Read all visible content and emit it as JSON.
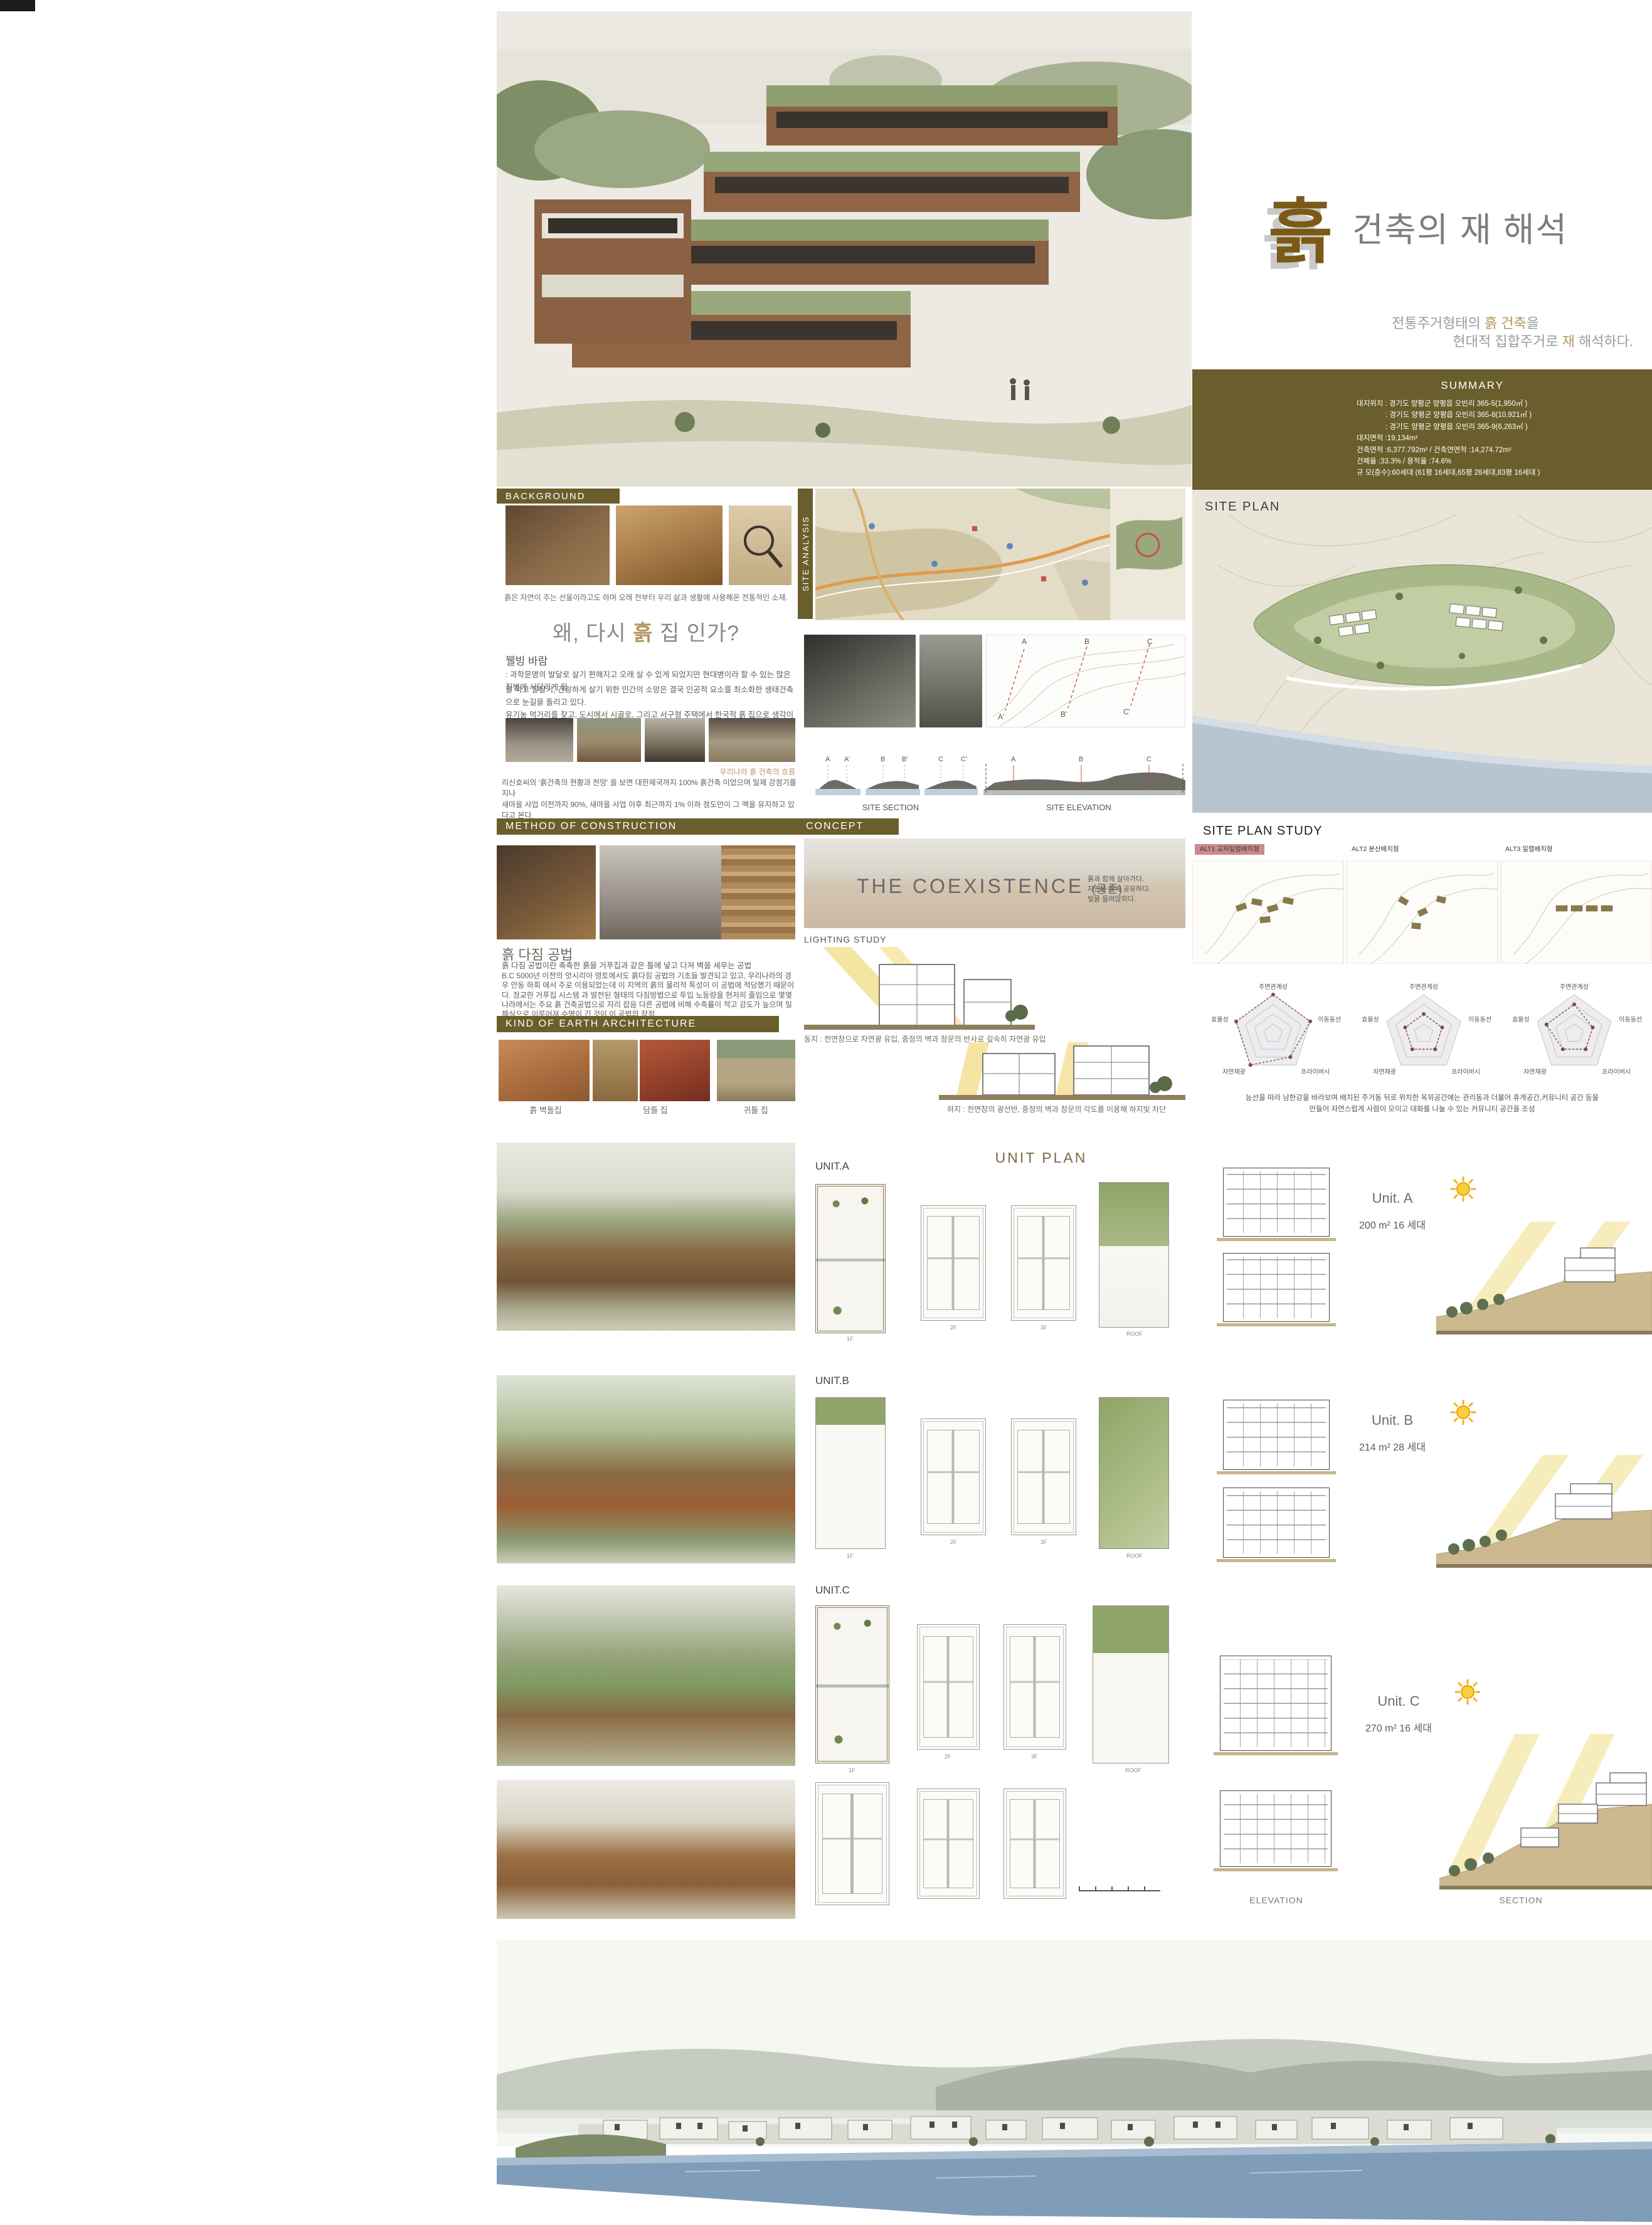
{
  "accent_colors": {
    "olive": "#6a5e2c",
    "tan": "#b3985f",
    "brown_logo": "#7b5a17",
    "alt_highlight": "#c98b8b",
    "radar_line": "#8a564c",
    "light_beam": "#f5df92",
    "water": "#7f9cb8"
  },
  "header": {
    "logo_char": "흙",
    "title": "건축의 재 해석",
    "subtitle": {
      "l1_pre": "전통주거형태의 ",
      "l1_accent": "흙 건축",
      "l1_post": "을",
      "l2_pre": "현대적 집합주거로 ",
      "l2_accent": "재",
      "l2_post": " 해석하다."
    }
  },
  "summary": {
    "heading": "SUMMARY",
    "lines": [
      "대지위치 : 경기도 양평군 양평읍 오빈리 365-5(1,950㎡ )",
      ": 경기도 양평군 양평읍 오빈리 365-8(10,921㎡ )",
      ": 경기도 양평군 양평읍 오빈리 365-9(6,263㎡ )",
      "대지면적 :19,134m²",
      "건축면적 :6,377.792m²  /  건축연면적 :14,274.72m²",
      "건폐율 :33.3%  /  용적율 :74.6%",
      "규 모(층수):60세대 (61평 16세대,65평 28세대,83평 16세대 )"
    ]
  },
  "site_plan": {
    "label": "SITE PLAN"
  },
  "background": {
    "heading": "BACKGROUND",
    "caption": "흙은 자연이 주는 선물이라고도 하며  오래 전부터 우리 삶과 생활에 사용해온 전통적인 소재."
  },
  "why": {
    "heading_pre": "왜, 다시 ",
    "heading_accent": "흙",
    "heading_post": " 집 인가?",
    "sub_heading": "웰빙 바람",
    "p1": ": 과학문명의 발달로 살기 편해지고 오래 살 수 있게 되었지만 현대병이라 할 수 있는 많은  질병에 시달리게 됨.",
    "p2a": "잘 먹고 잘살기, 건강하게 살기 위한 인간의 소망은 결국 인공적 요소를 최소화한 생태건축으로 눈길을 돌리고 있다.",
    "p2b": "유기농 먹거리를 찾고, 도시에서 시골로, 그리고 서구형 주택에서 한국적 흙 집으로 생각이 바뀌고 있는 것이다.",
    "flow_caption": "우리나라 흙 건축의 흐름",
    "flow_p1": "리신호씨의  ‘흙건축의 현황과 전망’ 을 보면 대한제국까지 100% 흙건축 이었으며 일제 강점기를 지나",
    "flow_p2": "새마을 사업 이전까지 90%, 새마을 사업 이후 최근까지 1% 이하 정도만이 그 맥을 유지하고 있다고 본다."
  },
  "site_analysis": {
    "label": "SITE  ANALYSIS",
    "section_title": "SITE SECTION",
    "elevation_title": "SITE ELEVATION",
    "sections": [
      [
        "A",
        "A'"
      ],
      [
        "B",
        "B'"
      ],
      [
        "C",
        "C'"
      ]
    ],
    "elevation_marks": [
      "A",
      "B",
      "C"
    ]
  },
  "method": {
    "heading": "METHOD  OF  CONSTRUCTION",
    "sub_heading": "흙 다짐 공법",
    "p1": "흙 다짐 공법이란 축축한 흙을 거푸집과 같은 틀에 넣고 다져 벽을 세우는 공법",
    "p2": "B.C 5000년 이전의 앗시리아 영토에서도 흙다짐 공법의 기초들 발견되고 있고, 우리나라의 경우 안동 하회 에서 주로 이용되었는데 이 지역의 흙의 물리적 특성이 이 공법에 적당했기 때문이다. 정교한 거푸집 시스템 과 발전된 형태의 다짐방법으로 투입 노동량을 현저히 줄임으로 몇몇나라에서는 주요 흙 건축공법으로 자리 잡음 다른 공법에 비해 수축률이 적고 강도가 높으며 일체식으로 이루어져 수명이 긴 것이 이 공법의 장점."
  },
  "kind": {
    "heading": "KIND  OF  EARTH  ARCHITECTURE",
    "labels": [
      "흙 벽돌집",
      "담틀 집",
      "귀틀 집"
    ]
  },
  "concept": {
    "heading": "CONCEPT",
    "title": "THE  COEXISTENCE",
    "suffix": "(공존)",
    "lines": [
      "흙과 함께 살아가다.",
      "자연을 함께 공유하다.",
      "빛을 들여앉히다."
    ]
  },
  "lighting": {
    "heading": "LIGHTING STUDY",
    "winter_caption": "동지 : 전면창으로 자연광 유입, 중정의 벽과 창문의 반사로 깊숙히 자연광 유입",
    "summer_caption": "하지 : 전면창의 광선반, 중정의 벽과 창문의 각도를 이용해 하지빛 차단"
  },
  "study": {
    "heading": "SITE PLAN STUDY",
    "alts": [
      "ALT1  교차일렬배치형",
      "ALT2  분산배치형",
      "ALT3  일렬배치형"
    ],
    "caption1": "능선을 따라 남한강을 바라보며 배치된 주거동 뒤로 위치한 옥외공간에는 관리동과 더불어 휴게공간,커뮤니티 공간 등을",
    "caption2": "만들어  자연스럽게 사람이 모이고 대화를 나눌 수 있는 커뮤니티 공간을 조성"
  },
  "chart_data": {
    "type": "radar",
    "axes": [
      "주변관계성",
      "이동동선",
      "프라이버시",
      "자연채광",
      "효율성"
    ],
    "max": 4,
    "rings": 4,
    "series": [
      {
        "name": "ALT1 교차일렬배치형",
        "values": [
          4,
          4,
          3,
          4,
          4
        ]
      },
      {
        "name": "ALT2 분산배치형",
        "values": [
          2,
          2,
          2,
          2,
          2
        ]
      },
      {
        "name": "ALT3 일렬배치형",
        "values": [
          3,
          2,
          2,
          2,
          3
        ]
      }
    ]
  },
  "units": {
    "title": "UNIT  PLAN",
    "floors": [
      "1F",
      "2F",
      "3F",
      "ROOF"
    ],
    "items": [
      {
        "tag": "UNIT.A",
        "name": "Unit. A",
        "info": "200 m²  16 세대"
      },
      {
        "tag": "UNIT.B",
        "name": "Unit. B",
        "info": "214 m²  28 세대"
      },
      {
        "tag": "UNIT.C",
        "name": "Unit. C",
        "info": "270 m²  16 세대"
      }
    ],
    "elevation_label": "ELEVATION",
    "section_label": "SECTION"
  }
}
